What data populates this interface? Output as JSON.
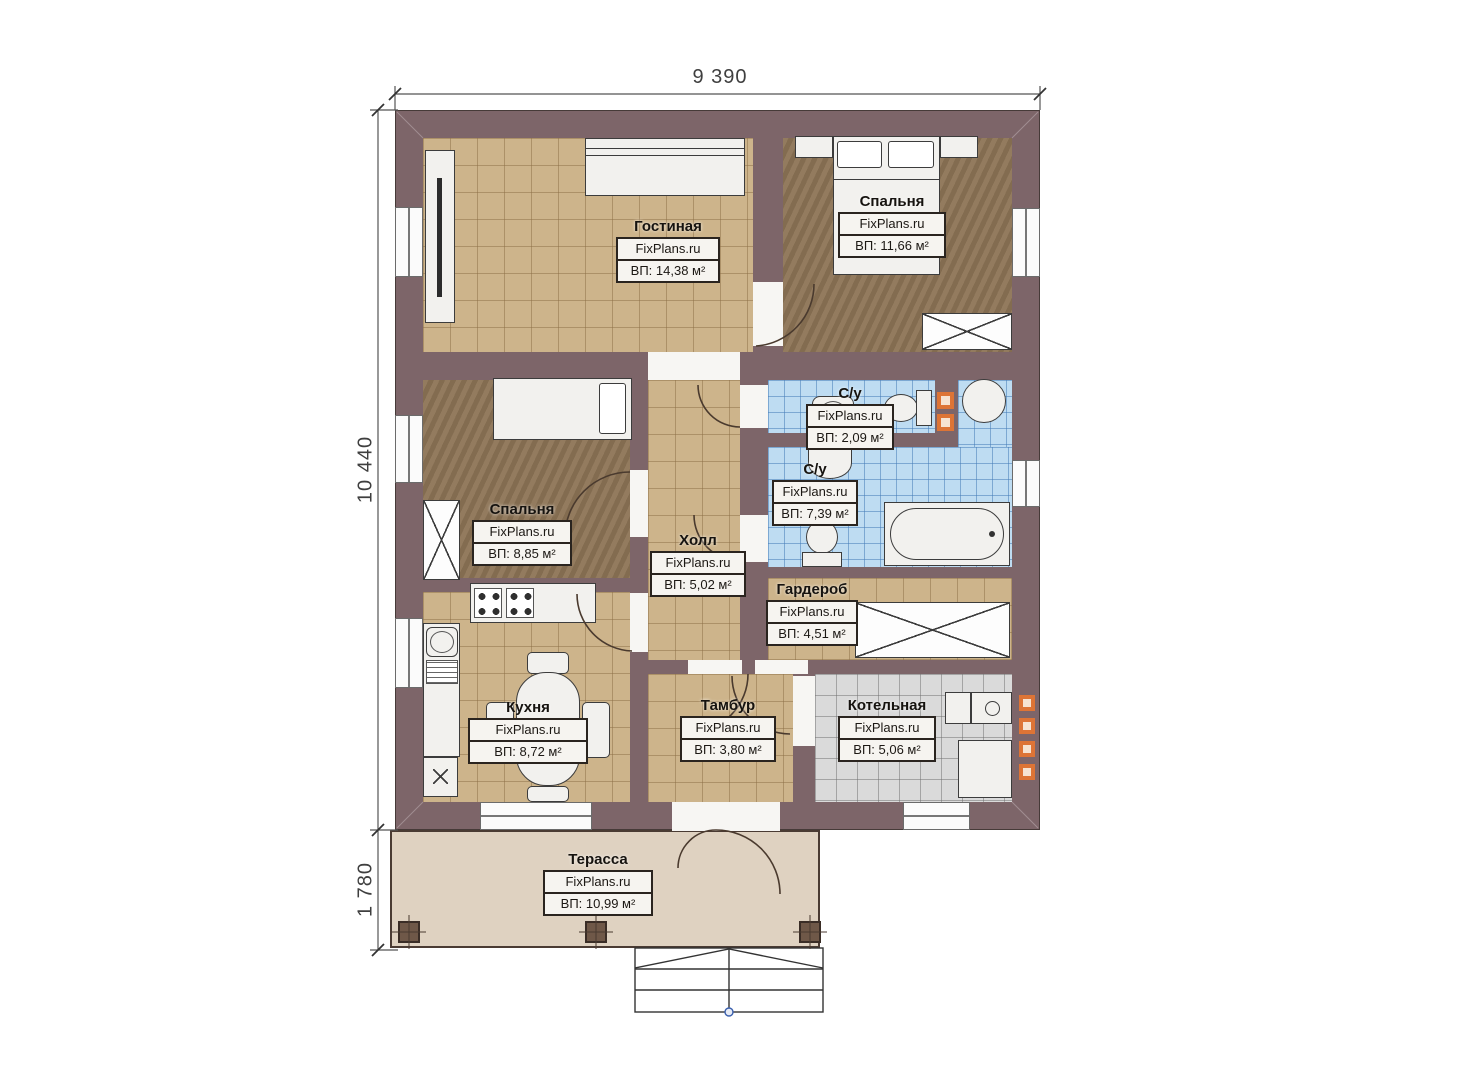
{
  "brand": "FixPlans.ru",
  "dimensions": {
    "width_top": "9 390",
    "height_left": "10 440",
    "terrace_height": "1 780"
  },
  "rooms": {
    "living": {
      "name": "Гостиная",
      "area": "ВП: 14,38 м²"
    },
    "bedroom_right": {
      "name": "Спальня",
      "area": "ВП: 11,66 м²"
    },
    "bedroom_left": {
      "name": "Спальня",
      "area": "ВП: 8,85 м²"
    },
    "hall": {
      "name": "Холл",
      "area": "ВП: 5,02 м²"
    },
    "wc_small": {
      "name": "С/у",
      "area": "ВП: 2,09 м²"
    },
    "wc_big": {
      "name": "С/у",
      "area": "ВП: 7,39 м²"
    },
    "wardrobe": {
      "name": "Гардероб",
      "area": "ВП: 4,51 м²"
    },
    "kitchen": {
      "name": "Кухня",
      "area": "ВП: 8,72 м²"
    },
    "tambour": {
      "name": "Тамбур",
      "area": "ВП: 3,80 м²"
    },
    "boiler": {
      "name": "Котельная",
      "area": "ВП: 5,06 м²"
    },
    "terrace": {
      "name": "Терасса",
      "area": "ВП: 10,99 м²"
    }
  },
  "colors": {
    "wall": "#7d6569",
    "floor_tile": "#cdb48b",
    "wet_zone_tile": "#bedcf2",
    "boiler_tile": "#dadada",
    "bedroom_floor": "#8d7456",
    "terrace_floor": "#dfd2c1",
    "accent_orange": "#dd7436"
  }
}
